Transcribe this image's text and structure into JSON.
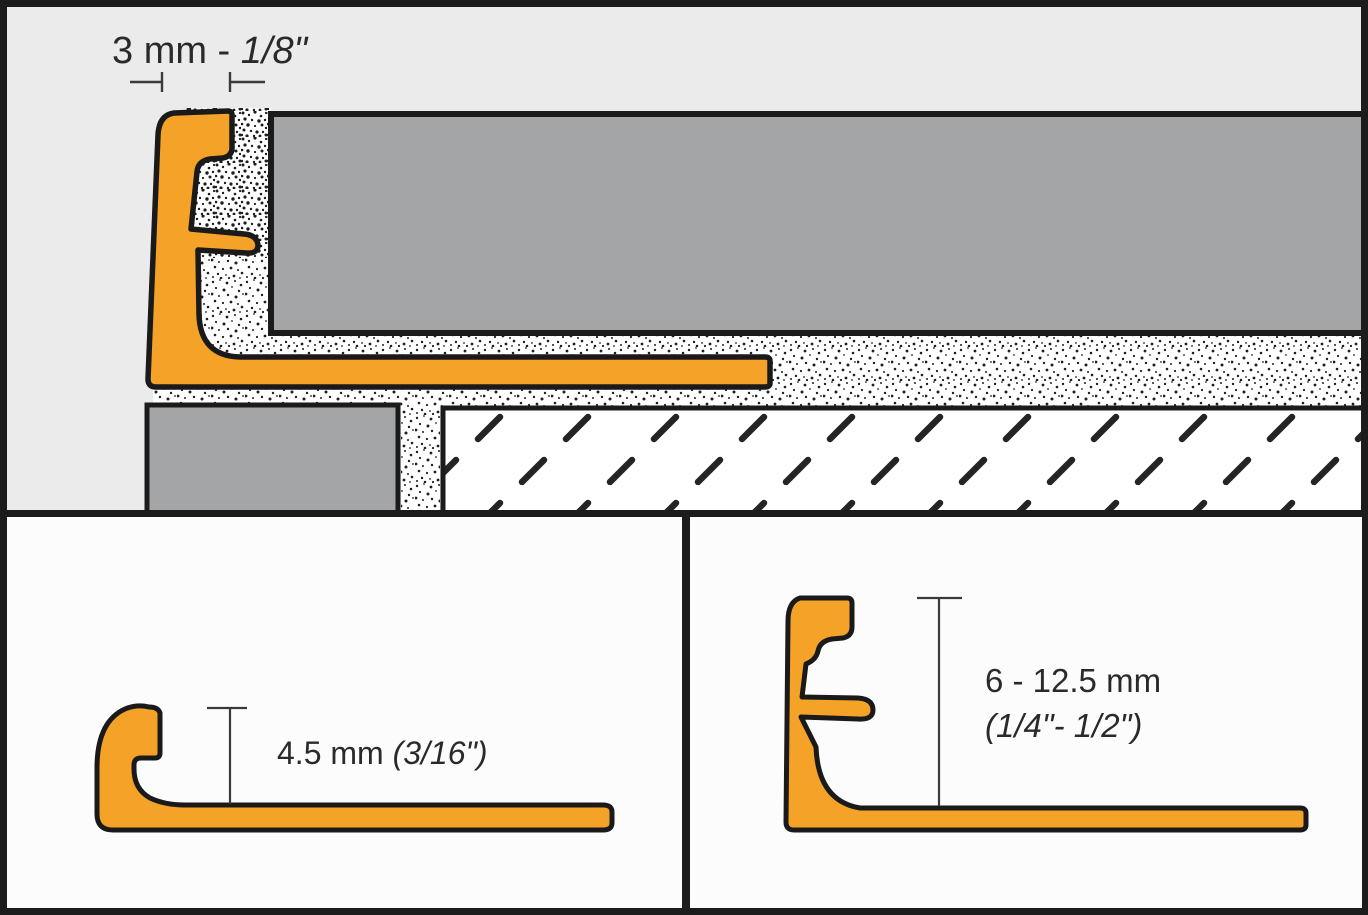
{
  "diagram": {
    "title": "tile edge trim profile cross-section diagram",
    "accent_color": "#F5A228",
    "tile_color": "#A4A5A7",
    "background_color": "#EBEBEB",
    "panel_color": "#FCFCFC",
    "outline_color": "#1A1A1A",
    "frame_color": "#1C1C1C"
  },
  "top_panel": {
    "dimension_metric": "3 mm - ",
    "dimension_imperial": "1/8\""
  },
  "bottom_left_panel": {
    "dimension_metric": "4.5 mm ",
    "dimension_imperial": "(3/16\")"
  },
  "bottom_right_panel": {
    "dimension_line1": "6 - 12.5 mm",
    "dimension_line2": "(1/4\"- 1/2\")"
  }
}
